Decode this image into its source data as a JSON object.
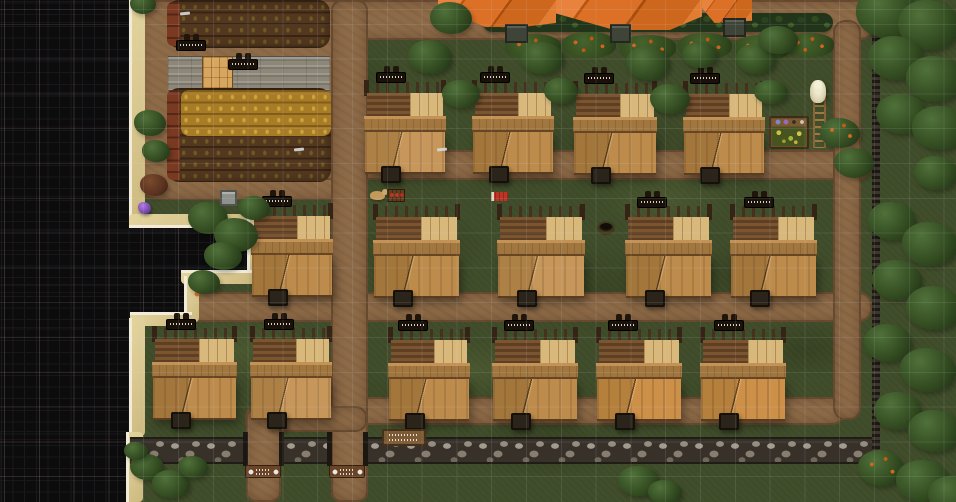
{
  "meta": {
    "app": "colony-sim-game-map",
    "view": "top-down village with fog of war",
    "canvas": {
      "w": 956,
      "h": 502
    }
  },
  "palette": {
    "grass": "#414e2b",
    "dirt": "#8e6b48",
    "fog": "#0c0c0d",
    "sand": "#d9c78c",
    "foam": "#f1ecda",
    "roof_orange": "#db7026",
    "hedge_green": "#223419",
    "stone_wall": "#8f877a",
    "house_wood_light": "#c08f4f",
    "house_wood_dark": "#6b4826",
    "ripe_crop": "#a87b26",
    "tilled_soil": "#53381f",
    "grid_line": "rgba(210,220,230,0.11)"
  },
  "scene": {
    "grass_patches": [
      {
        "x": 340,
        "y": 210,
        "w": 150,
        "h": 70,
        "v": "d"
      },
      {
        "x": 540,
        "y": 100,
        "w": 160,
        "h": 80,
        "v": "d"
      },
      {
        "x": 180,
        "y": 320,
        "w": 120,
        "h": 60,
        "v": "l"
      },
      {
        "x": 680,
        "y": 240,
        "w": 150,
        "h": 70,
        "v": "d"
      },
      {
        "x": 400,
        "y": 340,
        "w": 150,
        "h": 60,
        "v": "l"
      },
      {
        "x": 600,
        "y": 170,
        "w": 130,
        "h": 60,
        "v": "l"
      },
      {
        "x": 280,
        "y": 50,
        "w": 130,
        "h": 60,
        "v": "d"
      },
      {
        "x": 740,
        "y": 320,
        "w": 130,
        "h": 60,
        "v": "d"
      },
      {
        "x": 460,
        "y": 420,
        "w": 170,
        "h": 60,
        "v": "d"
      },
      {
        "x": 160,
        "y": 90,
        "w": 90,
        "h": 50,
        "v": "l"
      }
    ],
    "dirt": [
      {
        "x": 138,
        "y": 0,
        "w": 212,
        "h": 200,
        "r": 18
      },
      {
        "x": 350,
        "y": 0,
        "w": 524,
        "h": 40,
        "r": 14
      },
      {
        "x": 248,
        "y": 150,
        "w": 624,
        "h": 30,
        "r": 13
      },
      {
        "x": 140,
        "y": 292,
        "w": 732,
        "h": 30,
        "r": 13
      },
      {
        "x": 333,
        "y": 397,
        "w": 512,
        "h": 28,
        "r": 13
      },
      {
        "x": 331,
        "y": 0,
        "w": 37,
        "h": 502,
        "r": 10
      },
      {
        "x": 833,
        "y": 20,
        "w": 28,
        "h": 400,
        "r": 12
      },
      {
        "x": 245,
        "y": 406,
        "w": 122,
        "h": 26,
        "r": 11
      },
      {
        "x": 246,
        "y": 408,
        "w": 35,
        "h": 94,
        "r": 10
      }
    ],
    "stone_road": {
      "x": 168,
      "y": 56,
      "w": 162,
      "h": 33
    },
    "parquet_door": {
      "x": 202,
      "y": 56,
      "w": 31,
      "h": 33
    },
    "farms": [
      {
        "x": 167,
        "y": 0,
        "w": 163,
        "h": 48
      },
      {
        "x": 167,
        "y": 88,
        "w": 164,
        "h": 94
      }
    ],
    "farm_overlays": [
      {
        "cls": "redrow",
        "x": 167,
        "y": 2,
        "w": 13,
        "h": 44
      },
      {
        "cls": "redrow",
        "x": 167,
        "y": 90,
        "w": 13,
        "h": 90
      },
      {
        "cls": "ripe",
        "x": 181,
        "y": 90,
        "w": 150,
        "h": 46
      }
    ],
    "fog": [
      {
        "x": 0,
        "y": 0,
        "w": 132,
        "h": 222
      },
      {
        "x": 0,
        "y": 220,
        "w": 250,
        "h": 56
      },
      {
        "x": 0,
        "y": 276,
        "w": 188,
        "h": 42
      },
      {
        "x": 0,
        "y": 318,
        "w": 132,
        "h": 114
      },
      {
        "x": 0,
        "y": 430,
        "w": 129,
        "h": 72
      }
    ],
    "sand": [
      {
        "x": 129,
        "y": 0,
        "w": 13,
        "h": 222,
        "side": "l"
      },
      {
        "x": 129,
        "y": 214,
        "w": 128,
        "h": 11,
        "side": "b"
      },
      {
        "x": 247,
        "y": 218,
        "w": 11,
        "h": 62,
        "side": "l"
      },
      {
        "x": 181,
        "y": 270,
        "w": 77,
        "h": 11,
        "side": "t"
      },
      {
        "x": 184,
        "y": 276,
        "w": 12,
        "h": 46,
        "side": "l"
      },
      {
        "x": 130,
        "y": 312,
        "w": 62,
        "h": 11,
        "side": "t"
      },
      {
        "x": 129,
        "y": 318,
        "w": 13,
        "h": 118,
        "side": "l"
      },
      {
        "x": 126,
        "y": 432,
        "w": 14,
        "h": 70,
        "side": "l"
      }
    ],
    "hedge": {
      "x": 483,
      "y": 13,
      "w": 350,
      "h": 19
    },
    "bushes": [
      {
        "x": 505,
        "y": 34,
        "w": 56,
        "h": 26
      },
      {
        "x": 562,
        "y": 32,
        "w": 54,
        "h": 26
      },
      {
        "x": 620,
        "y": 35,
        "w": 56,
        "h": 26
      },
      {
        "x": 678,
        "y": 33,
        "w": 54,
        "h": 26
      },
      {
        "x": 734,
        "y": 35,
        "w": 56,
        "h": 26
      },
      {
        "x": 786,
        "y": 33,
        "w": 48,
        "h": 24
      }
    ],
    "walls": [
      {
        "x": 130,
        "y": 437,
        "w": 117,
        "h": 27
      },
      {
        "x": 282,
        "y": 437,
        "w": 48,
        "h": 27
      },
      {
        "x": 366,
        "y": 437,
        "w": 511,
        "h": 27
      }
    ],
    "palisade": {
      "x": 872,
      "y": 24,
      "w": 8,
      "h": 440
    },
    "gateposts": [
      {
        "x": 243,
        "y": 432,
        "w": 5,
        "h": 34
      },
      {
        "x": 279,
        "y": 432,
        "w": 5,
        "h": 34
      },
      {
        "x": 327,
        "y": 432,
        "w": 5,
        "h": 34
      },
      {
        "x": 363,
        "y": 432,
        "w": 5,
        "h": 34
      }
    ],
    "roofs": [
      {
        "x": 438,
        "y": 0,
        "w": 118,
        "h": 27,
        "v": "r1"
      },
      {
        "x": 556,
        "y": 0,
        "w": 146,
        "h": 30,
        "v": "r2"
      },
      {
        "x": 702,
        "y": 0,
        "w": 50,
        "h": 23,
        "v": "r3"
      }
    ],
    "chimneys": [
      {
        "x": 505,
        "y": 24,
        "w": 23,
        "h": 19
      },
      {
        "x": 610,
        "y": 24,
        "w": 21,
        "h": 19
      },
      {
        "x": 723,
        "y": 18,
        "w": 23,
        "h": 19
      }
    ],
    "houses": [
      {
        "x": 364,
        "y": 82,
        "w": 82,
        "v": 1
      },
      {
        "x": 472,
        "y": 82,
        "w": 82,
        "v": 0
      },
      {
        "x": 573,
        "y": 83,
        "w": 84,
        "v": 0
      },
      {
        "x": 683,
        "y": 83,
        "w": 82,
        "v": 0
      },
      {
        "x": 251,
        "y": 205,
        "w": 82,
        "v": 0
      },
      {
        "x": 373,
        "y": 206,
        "w": 87,
        "v": 0
      },
      {
        "x": 497,
        "y": 206,
        "w": 88,
        "v": 1
      },
      {
        "x": 625,
        "y": 206,
        "w": 87,
        "v": 0
      },
      {
        "x": 730,
        "y": 206,
        "w": 87,
        "v": 0
      },
      {
        "x": 152,
        "y": 328,
        "w": 85,
        "v": 0
      },
      {
        "x": 250,
        "y": 328,
        "w": 82,
        "v": 1
      },
      {
        "x": 388,
        "y": 329,
        "w": 82,
        "v": 0
      },
      {
        "x": 492,
        "y": 329,
        "w": 86,
        "v": 0
      },
      {
        "x": 596,
        "y": 329,
        "w": 86,
        "v": 2
      },
      {
        "x": 700,
        "y": 329,
        "w": 86,
        "v": 2
      }
    ],
    "signs": [
      {
        "t": "house",
        "x": 376,
        "y": 66
      },
      {
        "t": "house",
        "x": 480,
        "y": 66
      },
      {
        "t": "house",
        "x": 584,
        "y": 67
      },
      {
        "t": "house",
        "x": 690,
        "y": 67
      },
      {
        "t": "house",
        "x": 262,
        "y": 190
      },
      {
        "t": "house",
        "x": 637,
        "y": 191
      },
      {
        "t": "house",
        "x": 744,
        "y": 191
      },
      {
        "t": "house",
        "x": 166,
        "y": 313
      },
      {
        "t": "house",
        "x": 264,
        "y": 313
      },
      {
        "t": "house",
        "x": 398,
        "y": 314
      },
      {
        "t": "house",
        "x": 504,
        "y": 314
      },
      {
        "t": "house",
        "x": 608,
        "y": 314
      },
      {
        "t": "house",
        "x": 714,
        "y": 314
      },
      {
        "t": "farm",
        "x": 176,
        "y": 34
      },
      {
        "t": "road",
        "x": 228,
        "y": 53
      },
      {
        "t": "gate",
        "x": 245,
        "y": 465
      },
      {
        "t": "gate",
        "x": 329,
        "y": 465
      },
      {
        "t": "notice",
        "x": 382,
        "y": 429
      }
    ],
    "items": [
      {
        "t": "crate",
        "x": 220,
        "y": 190
      },
      {
        "t": "gem",
        "x": 138,
        "y": 202
      },
      {
        "t": "hole",
        "x": 599,
        "y": 223
      },
      {
        "t": "animal",
        "x": 370,
        "y": 191
      },
      {
        "t": "rack",
        "x": 387,
        "y": 189
      },
      {
        "t": "banner",
        "x": 491,
        "y": 192
      },
      {
        "t": "mush",
        "x": 192,
        "y": 283
      },
      {
        "t": "planter",
        "x": 769,
        "y": 116
      },
      {
        "t": "ladder",
        "x": 813,
        "y": 98
      },
      {
        "t": "figure",
        "x": 810,
        "y": 80
      },
      {
        "t": "tick",
        "x": 180,
        "y": 12
      },
      {
        "t": "tick",
        "x": 294,
        "y": 148
      },
      {
        "t": "tick",
        "x": 437,
        "y": 148
      }
    ],
    "trees": [
      {
        "x": 856,
        "y": -12,
        "w": 62,
        "h": 50
      },
      {
        "x": 898,
        "y": 0,
        "w": 62,
        "h": 50
      },
      {
        "x": 868,
        "y": 36,
        "w": 56,
        "h": 44
      },
      {
        "x": 906,
        "y": 56,
        "w": 58,
        "h": 46
      },
      {
        "x": 876,
        "y": 94,
        "w": 52,
        "h": 40
      },
      {
        "x": 912,
        "y": 106,
        "w": 56,
        "h": 44
      },
      {
        "x": 914,
        "y": 156,
        "w": 44,
        "h": 34
      },
      {
        "x": 868,
        "y": 202,
        "w": 48,
        "h": 38
      },
      {
        "x": 902,
        "y": 222,
        "w": 56,
        "h": 44
      },
      {
        "x": 872,
        "y": 260,
        "w": 50,
        "h": 40
      },
      {
        "x": 906,
        "y": 286,
        "w": 56,
        "h": 44
      },
      {
        "x": 864,
        "y": 324,
        "w": 48,
        "h": 38
      },
      {
        "x": 900,
        "y": 348,
        "w": 56,
        "h": 44
      },
      {
        "x": 874,
        "y": 392,
        "w": 48,
        "h": 38
      },
      {
        "x": 908,
        "y": 410,
        "w": 54,
        "h": 42
      },
      {
        "x": 858,
        "y": 450,
        "w": 46,
        "h": 36,
        "tone": "berry"
      },
      {
        "x": 896,
        "y": 460,
        "w": 54,
        "h": 42
      },
      {
        "x": 928,
        "y": 476,
        "w": 50,
        "h": 38
      },
      {
        "x": 430,
        "y": 2,
        "w": 42,
        "h": 32
      },
      {
        "x": 408,
        "y": 40,
        "w": 44,
        "h": 34
      },
      {
        "x": 442,
        "y": 80,
        "w": 38,
        "h": 28
      },
      {
        "x": 520,
        "y": 42,
        "w": 44,
        "h": 32
      },
      {
        "x": 544,
        "y": 78,
        "w": 34,
        "h": 26
      },
      {
        "x": 626,
        "y": 46,
        "w": 44,
        "h": 34
      },
      {
        "x": 650,
        "y": 84,
        "w": 40,
        "h": 30
      },
      {
        "x": 682,
        "y": 42,
        "w": 36,
        "h": 26
      },
      {
        "x": 736,
        "y": 44,
        "w": 40,
        "h": 30
      },
      {
        "x": 754,
        "y": 80,
        "w": 34,
        "h": 24
      },
      {
        "x": 758,
        "y": 26,
        "w": 40,
        "h": 28
      },
      {
        "x": 820,
        "y": 118,
        "w": 40,
        "h": 30,
        "tone": "berry"
      },
      {
        "x": 834,
        "y": 148,
        "w": 40,
        "h": 30
      },
      {
        "x": 188,
        "y": 202,
        "w": 40,
        "h": 32
      },
      {
        "x": 214,
        "y": 218,
        "w": 44,
        "h": 34
      },
      {
        "x": 238,
        "y": 196,
        "w": 32,
        "h": 24
      },
      {
        "x": 204,
        "y": 242,
        "w": 38,
        "h": 28
      },
      {
        "x": 188,
        "y": 270,
        "w": 32,
        "h": 24
      },
      {
        "x": 134,
        "y": 110,
        "w": 32,
        "h": 26
      },
      {
        "x": 142,
        "y": 140,
        "w": 28,
        "h": 22
      },
      {
        "x": 130,
        "y": -6,
        "w": 26,
        "h": 20
      },
      {
        "x": 140,
        "y": 174,
        "w": 28,
        "h": 22,
        "tone": "red"
      },
      {
        "x": 130,
        "y": 454,
        "w": 34,
        "h": 26
      },
      {
        "x": 152,
        "y": 470,
        "w": 38,
        "h": 28
      },
      {
        "x": 178,
        "y": 456,
        "w": 30,
        "h": 22
      },
      {
        "x": 124,
        "y": 442,
        "w": 24,
        "h": 18
      },
      {
        "x": 618,
        "y": 466,
        "w": 42,
        "h": 30
      },
      {
        "x": 648,
        "y": 480,
        "w": 34,
        "h": 24
      }
    ]
  }
}
